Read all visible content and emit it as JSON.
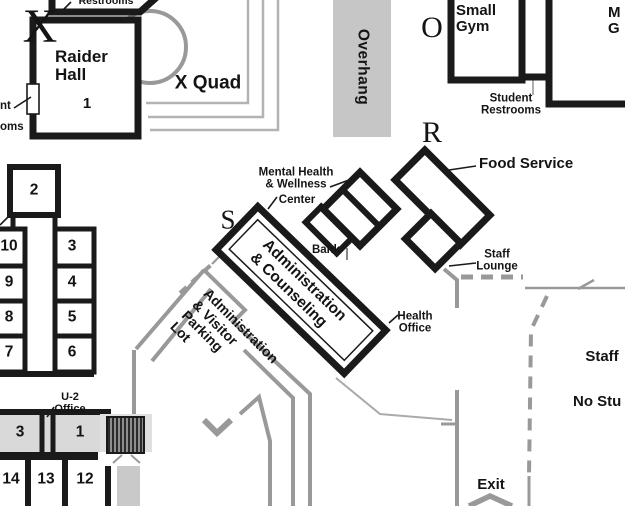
{
  "sections": {
    "x": "X",
    "o": "O",
    "r": "R",
    "s": "S"
  },
  "labels": {
    "restrooms_top": "Restrooms",
    "raider_hall": "Raider\nHall",
    "raider_hall_number": "1",
    "left_partial": "nt\noms",
    "x_quad": "X Quad",
    "overhang": "Overhang",
    "small_gym": "Small\nGym",
    "main_gym_partial": "M\nG",
    "student_restrooms": "Student\nRestrooms",
    "food_service": "Food Service",
    "staff_lounge": "Staff\nLounge",
    "mental_health": "Mental Health\n& Wellness",
    "mental_health_center": "Center",
    "bank": "Bank",
    "admin_counseling": "Administration\n& Counseling",
    "health_office": "Health\nOffice",
    "parking_lot": "Administration\n& Visitor\nParking\nLot",
    "u2_office": "U-2\nOffice",
    "staff": "Staff",
    "no_students_partial": "No Stu",
    "exit": "Exit"
  },
  "rooms": {
    "room2": "2",
    "west_wing": [
      "10",
      "9",
      "8",
      "7"
    ],
    "east_wing": [
      "3",
      "4",
      "5",
      "6"
    ],
    "south_row_top": [
      "3",
      "1"
    ],
    "south_row_bottom": [
      "14",
      "13",
      "12"
    ]
  },
  "colors": {
    "wall": "#1a1a1a",
    "path": "#999999",
    "room_fill": "#d9d9d9",
    "overhang_fill": "#c6c6c6"
  }
}
